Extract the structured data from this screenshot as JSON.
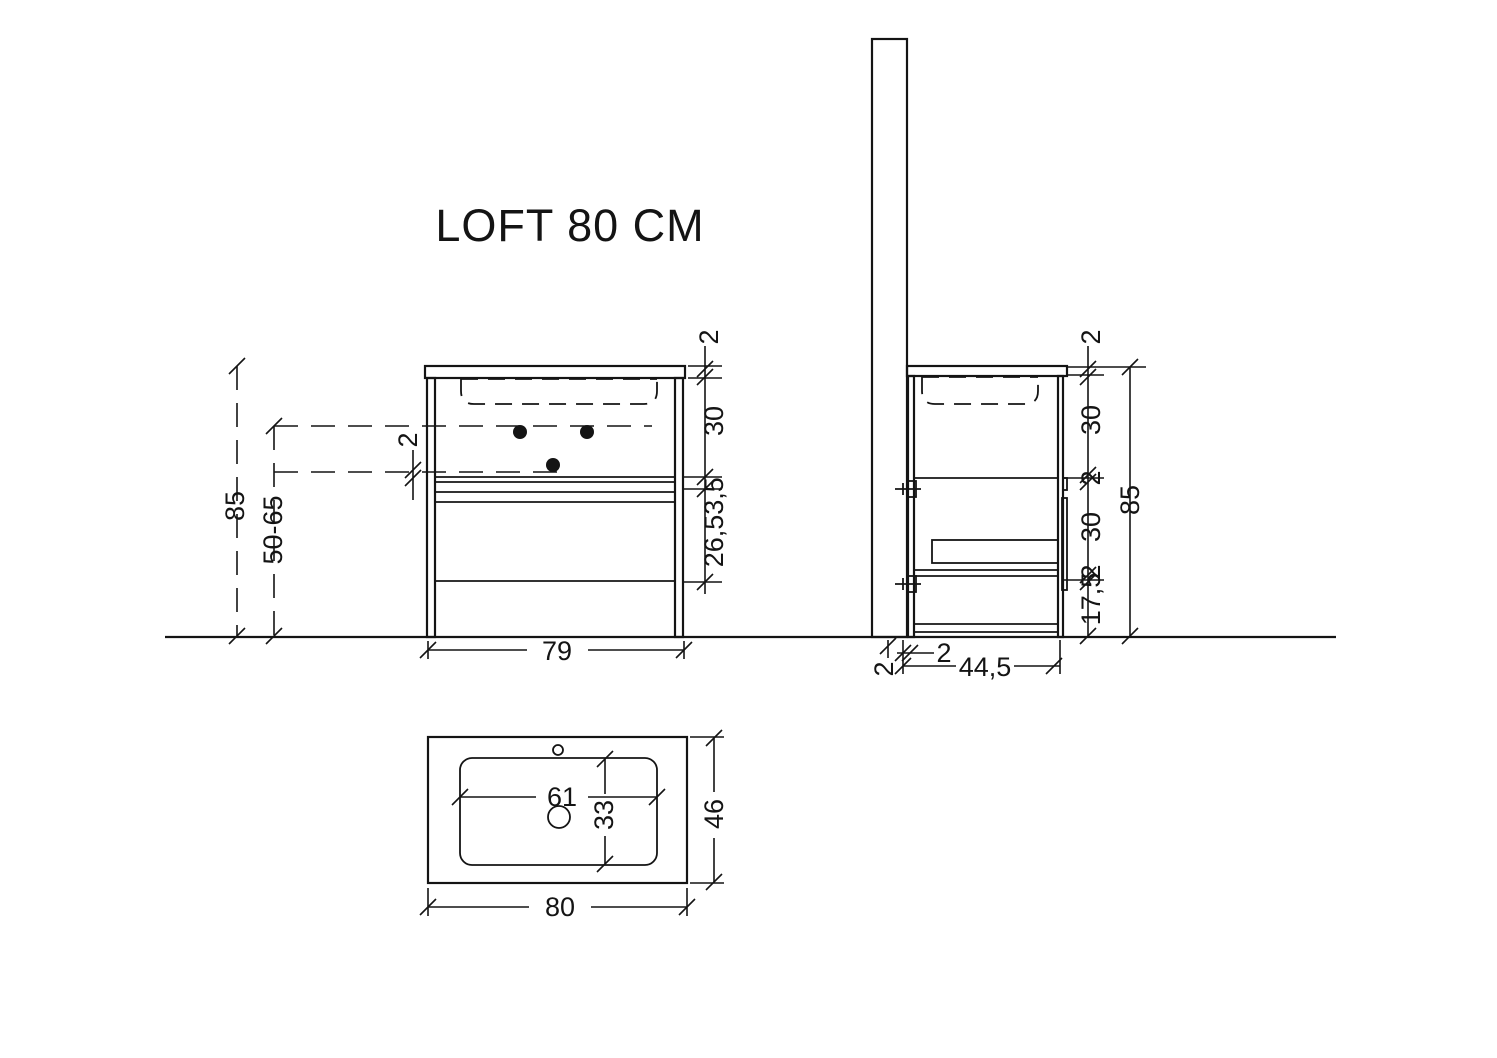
{
  "title": "LOFT 80 CM",
  "front_view": {
    "overall_height": "85",
    "installation_height_range": "50-65",
    "hole_offset": "2",
    "cabinet_width": "79",
    "top_thickness": "2",
    "basin_section_height": "30",
    "shelf_thickness": "3,5",
    "drawer_height": "26,5"
  },
  "side_view": {
    "top_thickness": "2",
    "basin_section_height": "30",
    "divider_thickness": "2",
    "drawer_section_height": "30",
    "base_thickness": "2",
    "plinth_height": "17,5",
    "overall_height": "85",
    "wall_offset": "2",
    "back_gap": "2",
    "cabinet_depth": "44,5"
  },
  "top_view": {
    "basin_width": "61",
    "basin_depth": "33",
    "counter_depth": "46",
    "counter_width": "80"
  }
}
